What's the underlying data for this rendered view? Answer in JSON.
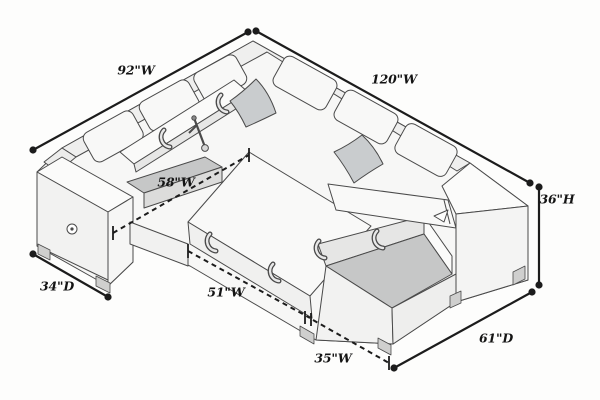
{
  "diagram": {
    "title": "Sectional sleeper sofa dimension diagram",
    "product": "sectional-sofa-with-storage-chaise",
    "background_color": "#fdfdfc",
    "line_color": "#1c1c1c",
    "sofa_fill_color": "#f7f7f6",
    "pillow_color": "#c9ccce",
    "storage_interior_color": "#c6c7c7",
    "icons": [
      "power-outlet-icon"
    ],
    "dimensions": [
      {
        "id": "back-left-width",
        "label": "92\"W",
        "style": "solid"
      },
      {
        "id": "back-right-width",
        "label": "120\"W",
        "style": "solid"
      },
      {
        "id": "seat-width",
        "label": "58\"W",
        "style": "dashed"
      },
      {
        "id": "overall-height",
        "label": "36\"H",
        "style": "solid"
      },
      {
        "id": "left-arm-depth",
        "label": "34\"D",
        "style": "solid"
      },
      {
        "id": "front-left-width",
        "label": "51\"W",
        "style": "dashed"
      },
      {
        "id": "front-right-width",
        "label": "35\"W",
        "style": "dashed"
      },
      {
        "id": "right-depth",
        "label": "61\"D",
        "style": "solid"
      }
    ]
  }
}
